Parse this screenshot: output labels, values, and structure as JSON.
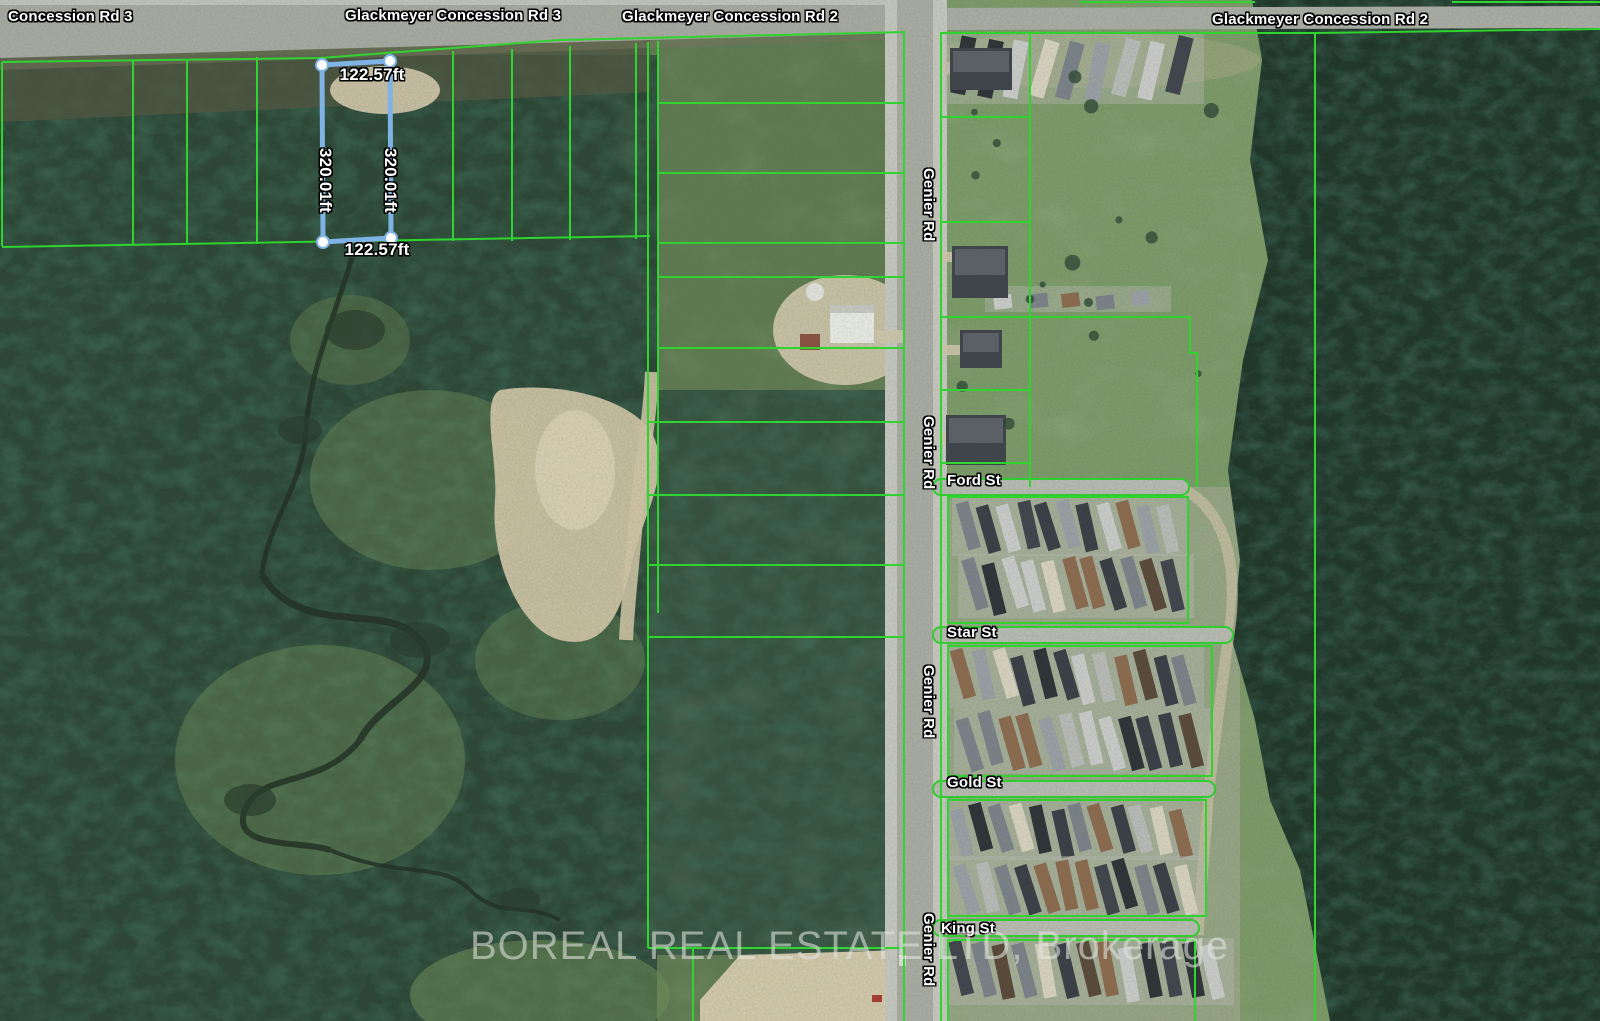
{
  "map": {
    "road_labels": [
      {
        "text": "Concession Rd 3"
      },
      {
        "text": "Glackmeyer Concession Rd 3"
      },
      {
        "text": "Glackmeyer Concession Rd 2"
      },
      {
        "text": "Glackmeyer Concession Rd 2"
      }
    ],
    "vertical_road_labels": [
      {
        "text": "Genier Rd"
      },
      {
        "text": "Genier Rd"
      },
      {
        "text": "Genier Rd"
      },
      {
        "text": "Genier Rd"
      }
    ],
    "street_labels": [
      {
        "text": "Ford St"
      },
      {
        "text": "Star St"
      },
      {
        "text": "Gold St"
      },
      {
        "text": "King St"
      }
    ],
    "parcel_measurements": {
      "width_top": "122.57ft",
      "width_bottom": "122.57ft",
      "height_left": "320.01ft",
      "height_right": "320.01ft"
    },
    "watermark": "BOREAL REAL ESTATE LTD, Brokerage",
    "colors": {
      "parcel_line": "#2fd42f",
      "measurement_line": "#7fb2e5",
      "label_text": "#ffffff",
      "watermark_text": "#e2e5df"
    }
  }
}
